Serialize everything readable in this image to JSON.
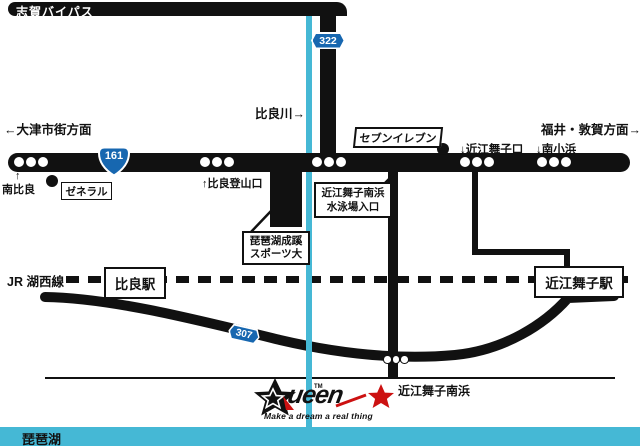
{
  "colors": {
    "road": "#111111",
    "river": "#45b8d5",
    "lake": "#45b8d5",
    "badge_blue": "#1767b0",
    "accent_red": "#cc1111"
  },
  "top": {
    "bypass_label": "志賀バイパス",
    "route322": "322",
    "river_label": "比良川→"
  },
  "directions": {
    "west": "←大津市街方面",
    "east": "福井・敦賀方面→"
  },
  "main_road": {
    "route161": "161",
    "minami_hira_arrow": "↑",
    "minami_hira": "南比良",
    "general_label": "ゼネラル",
    "hira_tozan": "↑比良登山口",
    "seven_eleven": "セブンイレブン",
    "omimaiko_guchi": "↓近江舞子口",
    "minami_kohama": "↓南小浜"
  },
  "pois": {
    "swim_line1": "近江舞子南浜",
    "swim_line2": "水泳場入口",
    "college_line1": "琵琶湖成蹊",
    "college_line2": "スポーツ大"
  },
  "railway": {
    "jr_label": "JR 湖西線",
    "hira_station": "比良駅",
    "omimaiko_station": "近江舞子駅"
  },
  "south_road": {
    "route307": "307",
    "beach_label": "近江舞子南浜"
  },
  "logo": {
    "text": "ueen",
    "tm": "TM",
    "tagline": "Make a dream a real thing"
  },
  "lake": {
    "label": "琵琶湖"
  }
}
